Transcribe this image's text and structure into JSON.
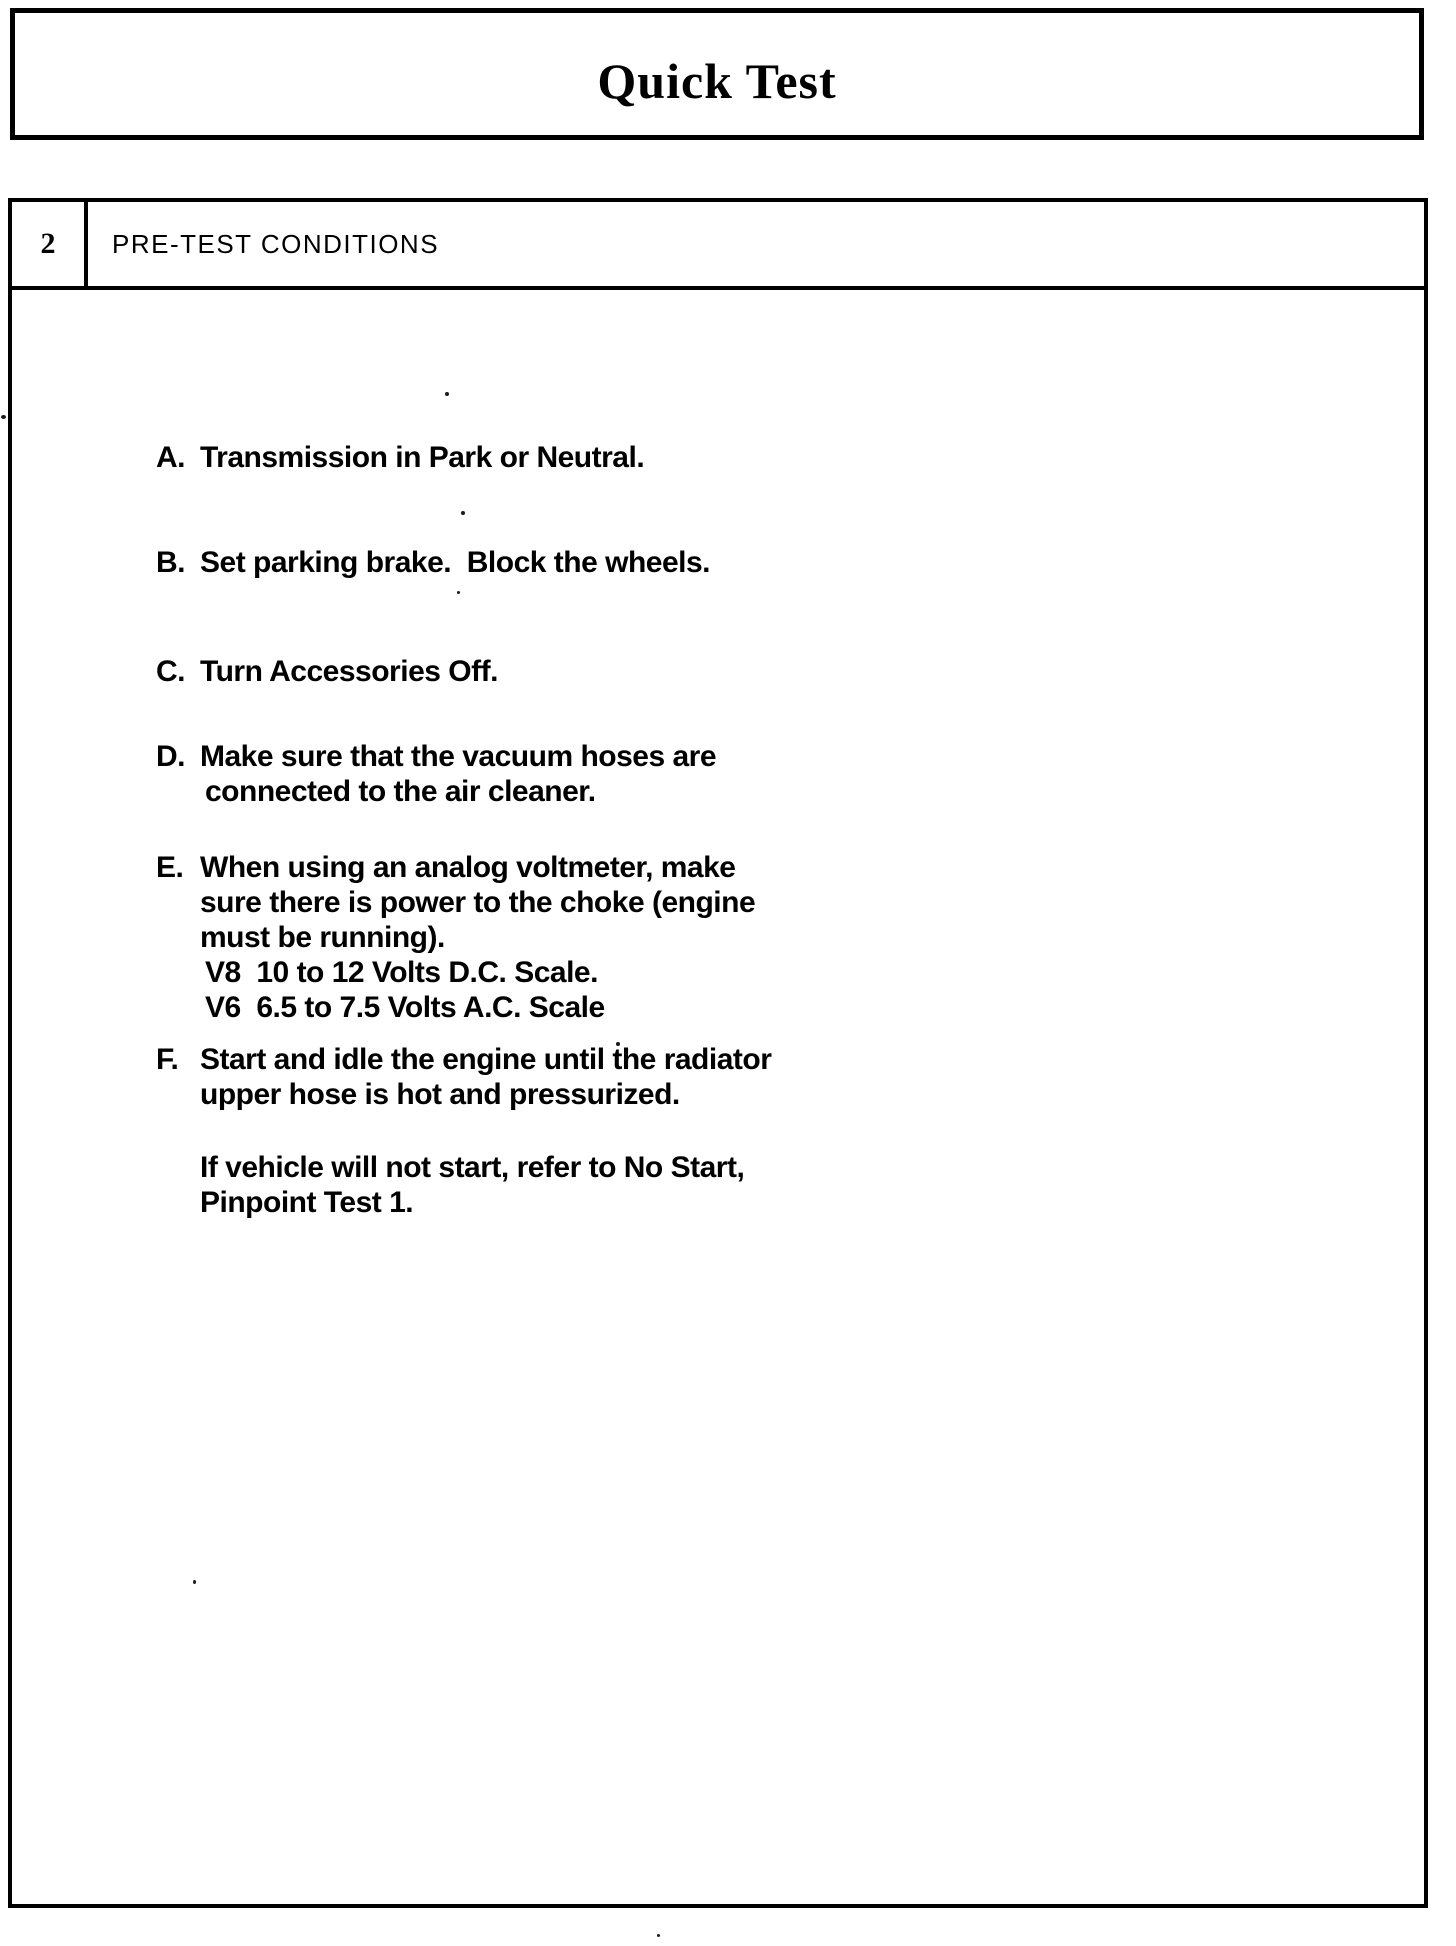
{
  "colors": {
    "ink": "#000000",
    "paper": "#ffffff"
  },
  "page": {
    "title": "Quick Test",
    "section": {
      "number": "2",
      "heading": "PRE-TEST CONDITIONS"
    },
    "items": [
      {
        "label": "A.",
        "lines": [
          "Transmission in Park or Neutral."
        ]
      },
      {
        "label": "B.",
        "lines": [
          "Set parking brake.  Block the wheels."
        ]
      },
      {
        "label": "C.",
        "lines": [
          "Turn Accessories Off."
        ]
      },
      {
        "label": "D.",
        "lines": [
          "Make sure that the vacuum hoses are",
          "connected to the air cleaner."
        ]
      },
      {
        "label": "E.",
        "lines": [
          "When using an analog voltmeter, make",
          "sure there is power to the choke (engine",
          "must be running).",
          "V8  10 to 12 Volts D.C. Scale.",
          "V6  6.5 to 7.5 Volts A.C. Scale"
        ]
      },
      {
        "label": "F.",
        "lines": [
          "Start and idle the engine until the radiator",
          "upper hose is hot and pressurized."
        ]
      }
    ],
    "note_lines": [
      "If vehicle will not start, refer to No Start,",
      "Pinpoint Test 1."
    ]
  }
}
